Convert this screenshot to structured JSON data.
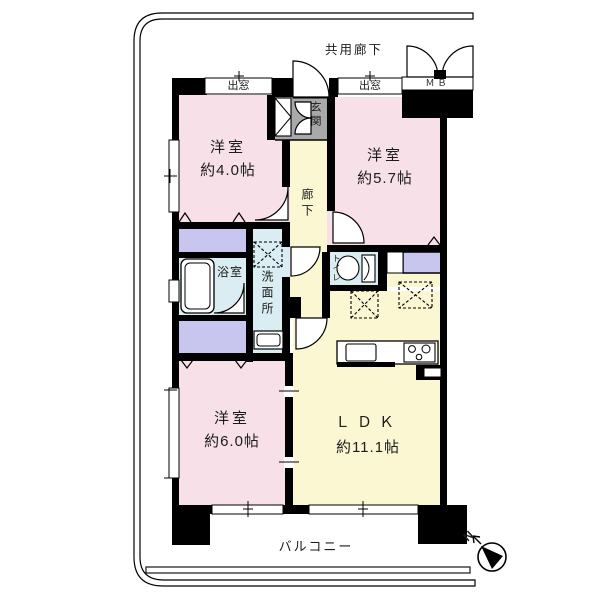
{
  "plan": {
    "common_corridor": "共用廊下",
    "balcony": "バルコニー",
    "compass_north": "N",
    "rooms": [
      {
        "name": "洋室",
        "size": "約4.0帖"
      },
      {
        "name": "洋室",
        "size": "約5.7帖"
      },
      {
        "name": "洋室",
        "size": "約6.0帖"
      },
      {
        "name": "ＬＤＫ",
        "size": "約11.1帖"
      }
    ],
    "labels": {
      "bay_window_left": "出窓",
      "bay_window_right": "出窓",
      "meter_box": "ＭＢ",
      "entrance": "玄関",
      "hallway": "廊下",
      "bathroom": "浴室",
      "washroom": "洗面所",
      "toilet": "トイレ"
    },
    "colors": {
      "bedroom_pink": "#f8e0e9",
      "ldk_yellow": "#fbf7d2",
      "closet_purple": "#c8c5ee",
      "wet_area_blue": "#d9edf2",
      "entrance_gray": "#a9a9a9",
      "wall_black": "#000000"
    }
  }
}
